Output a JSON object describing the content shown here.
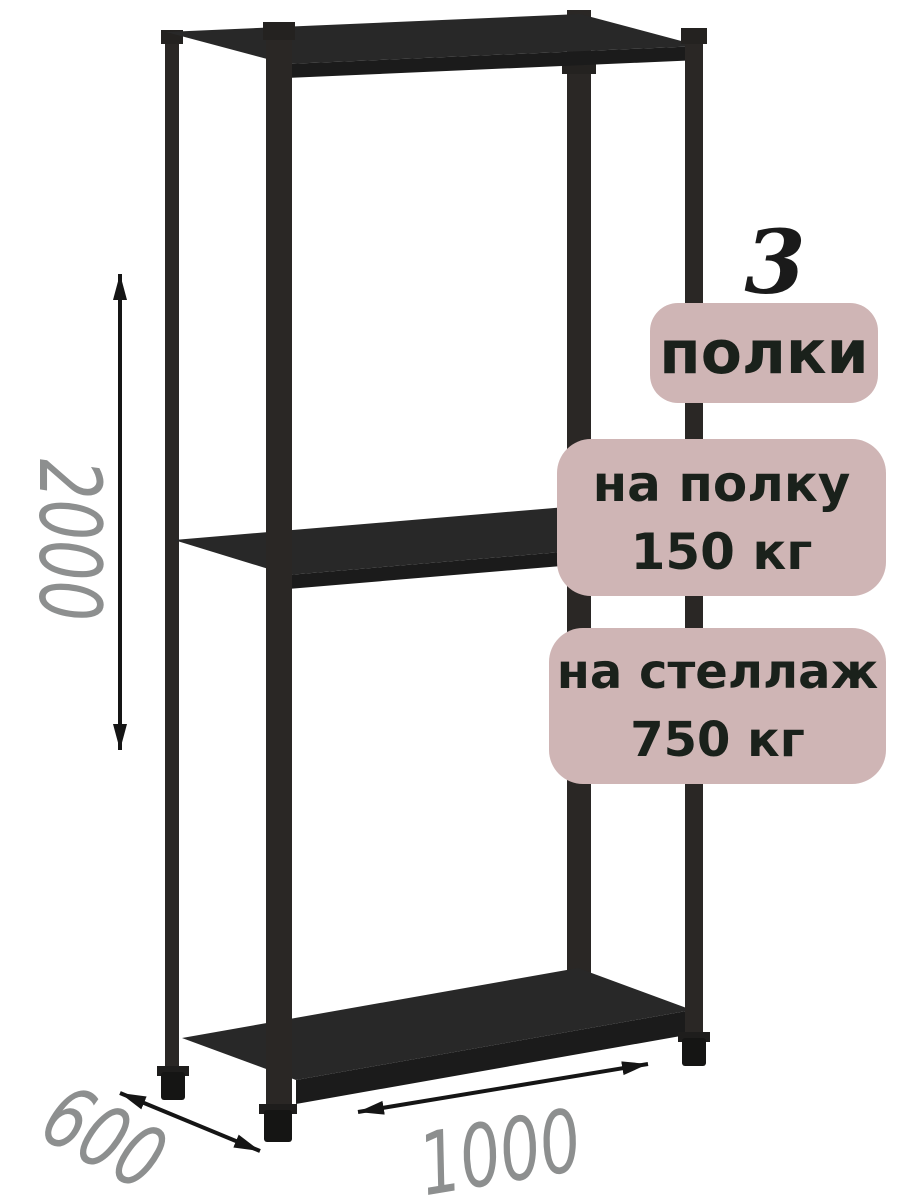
{
  "annotations": {
    "shelf_count": {
      "value": "3",
      "label": "полки"
    },
    "shelf_capacity": {
      "line1": "на полку",
      "line2": "150 кг"
    },
    "rack_capacity": {
      "line1": "на стеллаж",
      "line2": "750 кг"
    }
  },
  "dimensions": {
    "height": "2000",
    "width": "1000",
    "depth": "600"
  },
  "colors": {
    "background": "#ffffff",
    "badge_background": "#cfb5b5",
    "badge_text": "#1a211b",
    "count_text": "#1a1a1a",
    "dimension_text": "#8d8f8f",
    "arrow": "#151515",
    "metal": "#272421"
  }
}
